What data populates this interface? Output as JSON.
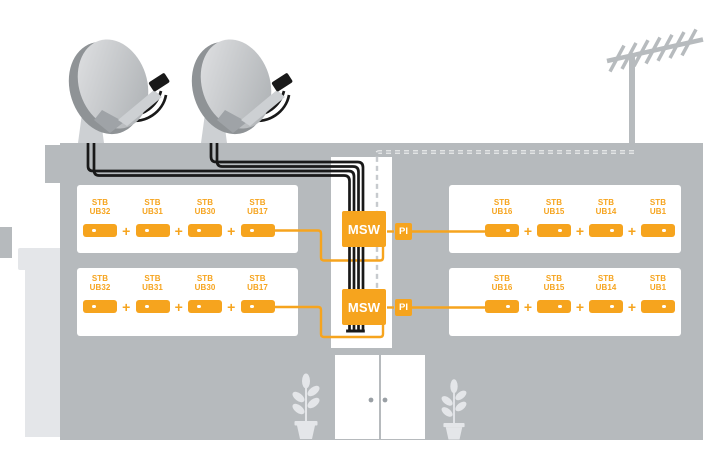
{
  "palette": {
    "orange": "#F6A41E",
    "building_gray": "#b6babd",
    "annex_gray": "#e4e6e9",
    "cable_black": "#191919",
    "dash_gray": "#bdc1c5",
    "metal_gray": "#b7bbbe",
    "white": "#ffffff"
  },
  "labels": {
    "plus": "+"
  },
  "devices": {
    "multiswitch_top": "MSW",
    "multiswitch_bottom": "MSW",
    "power_inserter_top": "PI",
    "power_inserter_bottom": "PI"
  },
  "rooms": {
    "top_left": {
      "stbs": [
        {
          "l1": "STB",
          "l2": "UB32"
        },
        {
          "l1": "STB",
          "l2": "UB31"
        },
        {
          "l1": "STB",
          "l2": "UB30"
        },
        {
          "l1": "STB",
          "l2": "UB17"
        }
      ]
    },
    "bottom_left": {
      "stbs": [
        {
          "l1": "STB",
          "l2": "UB32"
        },
        {
          "l1": "STB",
          "l2": "UB31"
        },
        {
          "l1": "STB",
          "l2": "UB30"
        },
        {
          "l1": "STB",
          "l2": "UB17"
        }
      ]
    },
    "top_right": {
      "stbs": [
        {
          "l1": "STB",
          "l2": "UB16"
        },
        {
          "l1": "STB",
          "l2": "UB15"
        },
        {
          "l1": "STB",
          "l2": "UB14"
        },
        {
          "l1": "STB",
          "l2": "UB1"
        }
      ]
    },
    "bottom_right": {
      "stbs": [
        {
          "l1": "STB",
          "l2": "UB16"
        },
        {
          "l1": "STB",
          "l2": "UB15"
        },
        {
          "l1": "STB",
          "l2": "UB14"
        },
        {
          "l1": "STB",
          "l2": "UB1"
        }
      ]
    }
  },
  "icons": {
    "satellite_dish": "satellite-dish",
    "terrestrial_antenna": "yagi-antenna",
    "potted_plant": "potted-plant",
    "entrance_door": "door",
    "coax_cable": "coax-cable",
    "terrestrial_feed": "dashed-feed-line"
  }
}
